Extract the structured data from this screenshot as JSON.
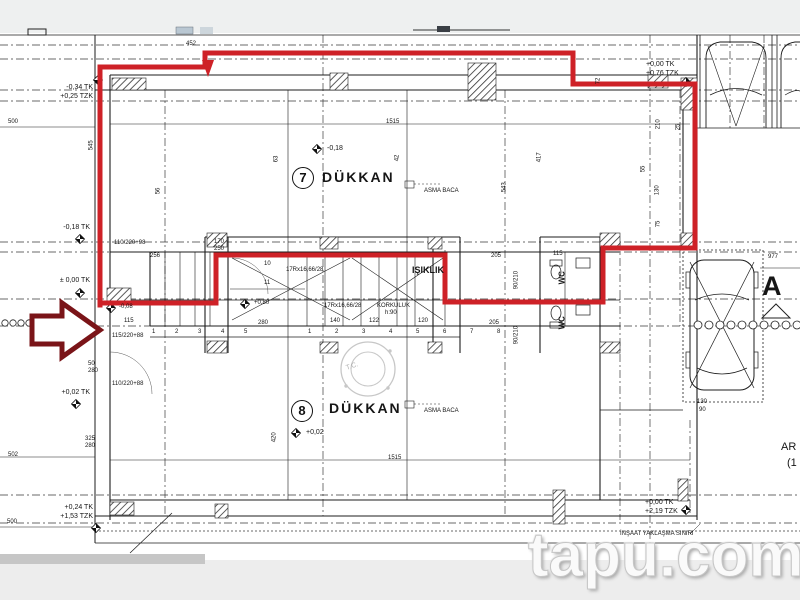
{
  "watermark": "tapu.com",
  "stamp": "T.C.",
  "rooms": {
    "shop7_number": "7",
    "shop7_label": "DÜKKAN",
    "shop8_number": "8",
    "shop8_label": "DÜKKAN",
    "lightwell": "IŞIKLIK",
    "wc": "WC",
    "flue": "ASMA BACA"
  },
  "section": {
    "letter": "A",
    "edge_text_1": "AR",
    "edge_text_2": "(1"
  },
  "elevations": {
    "top_left": [
      "-0,34 TK",
      "+0,25 TZK"
    ],
    "left_1": "-0,18 TK",
    "left_2": "± 0,00 TK",
    "left_3": "+0,02 TK",
    "bottom_left": [
      "+0,24 TK",
      "+1,53 TZK"
    ],
    "top_right": [
      "+0,00 TK",
      "+0,76 TZK"
    ],
    "bottom_right": [
      "+0,00 TK",
      "+2,19 TZK"
    ],
    "in_plan": {
      "shop7": "-0,18",
      "hall": "-0,08",
      "stair": "+0,80",
      "shop8": "+0,02"
    }
  },
  "stairs": {
    "riser_note": "17Rx16,66/28",
    "railing_1": "KORKULUK",
    "railing_2": "h:90",
    "left_numbers": "1 2 3 4 5",
    "right_numbers": "1 2 3 4 5 6 7 8",
    "n10": "10",
    "n11": "11"
  },
  "doors": {
    "d1": "110/220+98",
    "d2": "115/220+88",
    "d3": "110/220+88",
    "d4": "90/210"
  },
  "boundary_note": "İNŞAAT YAKLAŞMA SINIRI",
  "dims": {
    "top": "452",
    "left_upper": "500",
    "mid_upper": "1515",
    "left_lower": "502",
    "mid_lower": "1515",
    "left_bottom": "500",
    "right": "977",
    "hall_width": "115",
    "hall_256": "256",
    "s170": "170",
    "s250": "250",
    "s280": "280",
    "s140": "140",
    "s122": "122",
    "s120": "120",
    "c205a": "205",
    "c205b": "205",
    "c115": "115",
    "p130": "130",
    "p90": "90",
    "v545": "545",
    "v56": "56",
    "v63": "63",
    "v42": "42",
    "v417": "417",
    "v543": "543",
    "v210": "210",
    "v72": "72",
    "v25": "25",
    "v55": "55",
    "v130": "130",
    "v75": "75",
    "v420": "420",
    "w50": "50",
    "w280": "280",
    "w325": "325",
    "w280b": "280"
  }
}
